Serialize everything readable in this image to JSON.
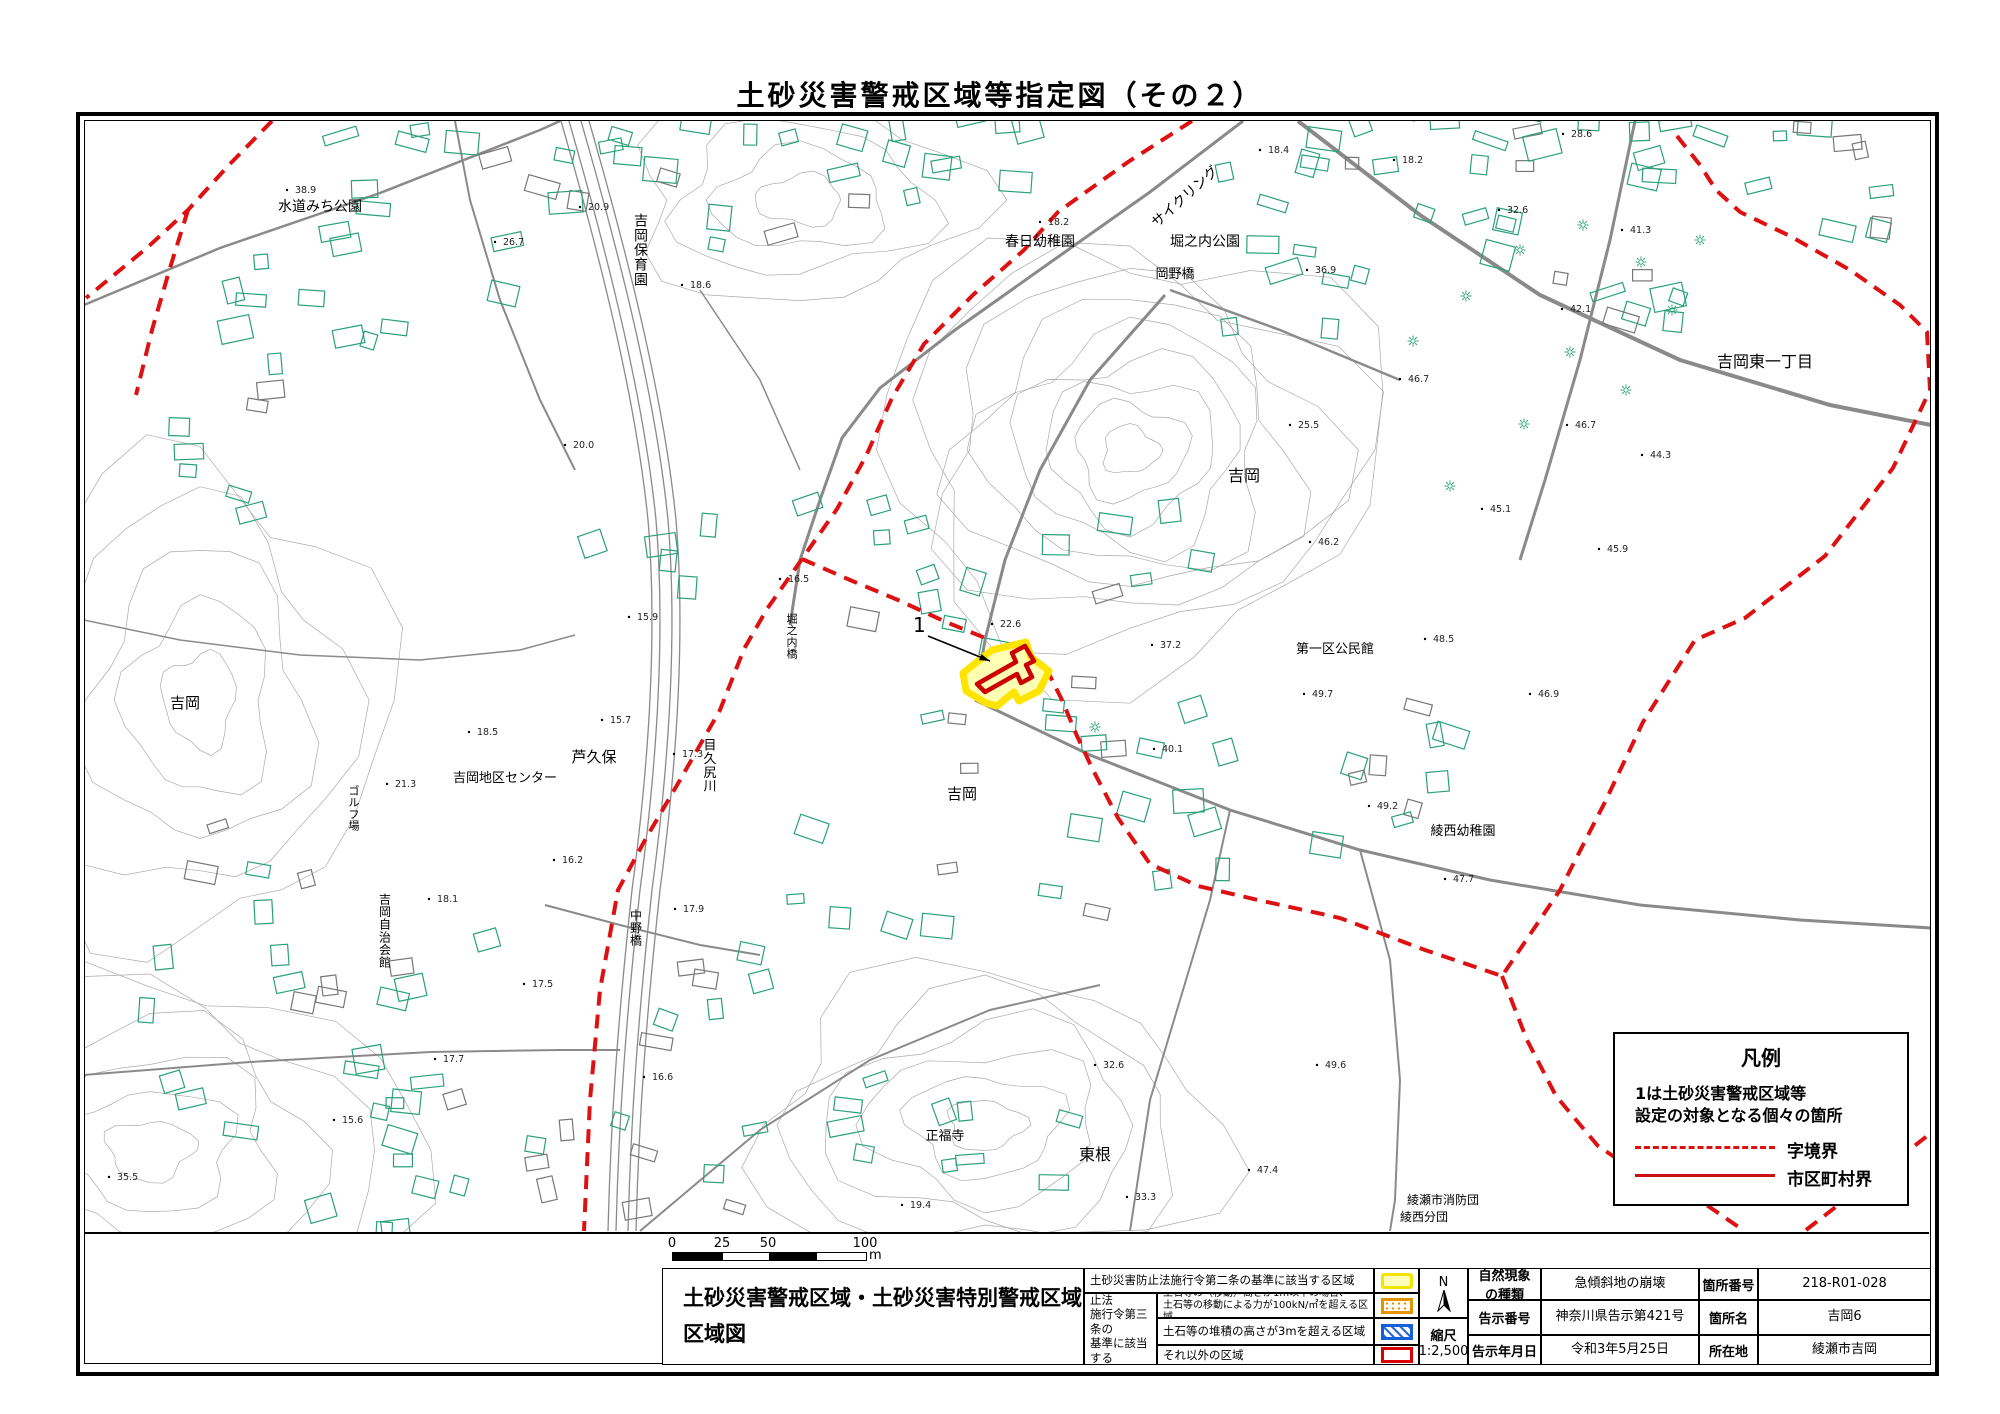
{
  "title": "土砂災害警戒区域等指定図（その２）",
  "legend": {
    "title": "凡例",
    "line1": "1は土砂災害警戒区域等",
    "line2": "設定の対象となる個々の箇所",
    "dashed_label": "字境界",
    "solid_label": "市区町村界",
    "dashed_color": "#dd1111",
    "solid_color": "#cc1111"
  },
  "scale_bar": {
    "ticks": [
      "0",
      "25",
      "50",
      "100"
    ],
    "unit": "m"
  },
  "table": {
    "map_title_line1": "土砂災害警戒区域・土砂災害特別警戒区域",
    "map_title_line2": "区域図",
    "row1_desc": "土砂災害防止法施行令第二条の基準に該当する区域",
    "law_line1": "土砂災害防止法",
    "law_line2": "施行令第三条の",
    "law_line3": "基準に該当する",
    "law_line4": "区域",
    "row2_desc_line1": "土石等の（移動）高さが1m以下の場合、",
    "row2_desc_line2": "土石等の移動による力が100kN/㎡を超える区域",
    "row3_desc": "土石等の堆積の高さが3mを超える区域",
    "row4_desc": "それ以外の区域",
    "north_label": "N",
    "scale_label": "縮尺",
    "scale_value": "1:2,500",
    "nature_label_l1": "自然現象",
    "nature_label_l2": "の種類",
    "nature_value": "急傾斜地の崩壊",
    "notice_no_label": "告示番号",
    "notice_no_value": "神奈川県告示第421号",
    "notice_date_label": "告示年月日",
    "notice_date_value": "令和3年5月25日",
    "site_no_label": "箇所番号",
    "site_no_value": "218-R01-028",
    "site_name_label": "箇所名",
    "site_name_value": "吉岡6",
    "location_label": "所在地",
    "location_value": "綾瀬市吉岡"
  },
  "map": {
    "marker": {
      "label": "1",
      "x": 913,
      "y": 632,
      "arrow": [
        928,
        636,
        990,
        661
      ]
    },
    "zone_fill": "#ffffb3",
    "zone_stroke": "#ffe400",
    "special_stroke": "#cc0000",
    "boundary_color": "#dd1111",
    "zone_points": "963,673 992,650 1026,642 1031,657 1049,671 1039,691 1019,701 1014,692 997,706 986,703 966,691",
    "special_path": "M 977,684 L 1016,662 L 1012,653 L 1025,646 L 1034,661 L 1026,665 L 1032,677 L 1021,683 L 1017,674 L 985,692 Z",
    "dashes": [
      "M 272,121 L 228,166 L 188,210 L 148,247 L 86,298",
      "M 188,210 L 170,268 L 152,330 L 136,395",
      "M 1192,121 L 1128,162 L 1058,212 L 1024,250 L 974,294 L 924,344 L 892,398 L 866,456 L 837,509 L 802,559 L 767,609 L 744,649 L 720,710 L 680,780 L 645,840 L 618,890 L 600,990 L 590,1100 L 584,1231",
      "M 802,559 L 850,580 L 898,600 L 946,622 L 990,640",
      "M 1046,668 L 1062,700 L 1077,736 L 1093,770 L 1118,818 L 1150,864 L 1198,886 L 1258,900 L 1340,918 L 1425,950 L 1502,976",
      "M 1677,136 L 1700,165 L 1716,190 L 1740,212 L 1790,236 L 1850,270 L 1900,305 L 1927,332 L 1930,390 L 1893,468 L 1825,556 L 1745,618 L 1695,640 L 1643,722 L 1605,802 L 1560,890 L 1502,976",
      "M 1502,976 L 1527,1040 L 1556,1096 L 1598,1146 L 1658,1186 L 1708,1206 L 1743,1230",
      "M 1806,1230 L 1868,1182 L 1931,1133"
    ],
    "river": {
      "d": "M 575,121 C 615,260 650,400 662,520 C 672,640 662,770 646,890 C 633,1010 625,1110 622,1231",
      "offsets": [
        -14,
        -6,
        6,
        14
      ]
    },
    "roads": [
      {
        "d": "M 1243,121 L 1150,192 L 1048,264 L 955,330 L 880,388 L 842,438 L 820,500 L 800,560 L 790,625",
        "w": 3
      },
      {
        "d": "M 84,305 L 220,248 L 380,193 L 540,130 L 560,121",
        "w": 2.5
      },
      {
        "d": "M 455,121 L 470,200 L 500,300 L 540,400 L 575,470",
        "w": 2
      },
      {
        "d": "M 1298,121 L 1420,215 L 1540,295 L 1680,360 L 1830,405 L 1931,425",
        "w": 4
      },
      {
        "d": "M 1635,121 L 1610,240 L 1580,360 L 1545,480 L 1520,560",
        "w": 3
      },
      {
        "d": "M 1165,295 L 1090,380 L 1040,470 L 1005,560 L 985,640 L 975,700",
        "w": 3
      },
      {
        "d": "M 975,700 L 1090,755 L 1230,810 L 1360,850 L 1490,880 L 1640,905 L 1800,920 L 1931,928",
        "w": 3
      },
      {
        "d": "M 1360,850 L 1390,960 L 1400,1080 L 1395,1200 L 1390,1231",
        "w": 2
      },
      {
        "d": "M 84,1075 L 250,1062 L 430,1052 L 560,1050 L 620,1050",
        "w": 2
      },
      {
        "d": "M 640,1231 L 760,1130 L 870,1060 L 990,1010 L 1100,985",
        "w": 2
      },
      {
        "d": "M 545,905 L 620,925 L 700,945 L 760,955",
        "w": 2
      },
      {
        "d": "M 84,620 L 180,640 L 300,655 L 420,660 L 520,650 L 575,635",
        "w": 1.5
      },
      {
        "d": "M 1230,810 L 1210,900 L 1180,1000 L 1150,1100 L 1130,1231",
        "w": 2
      },
      {
        "d": "M 700,290 L 760,380 L 800,470",
        "w": 1.5
      },
      {
        "d": "M 1170,290 L 1280,330 L 1400,380",
        "w": 2.5
      }
    ],
    "contour_zones": [
      {
        "cx": 1130,
        "cy": 450,
        "rx": 250,
        "ry": 215,
        "n": 9
      },
      {
        "cx": 985,
        "cy": 1125,
        "rx": 230,
        "ry": 150,
        "n": 6
      },
      {
        "cx": 150,
        "cy": 1150,
        "rx": 260,
        "ry": 180,
        "n": 6
      },
      {
        "cx": 200,
        "cy": 700,
        "rx": 180,
        "ry": 240,
        "n": 5
      },
      {
        "cx": 800,
        "cy": 200,
        "rx": 170,
        "ry": 100,
        "n": 4
      }
    ],
    "building_clusters": [
      [
        380,
        230,
        170,
        100,
        16
      ],
      [
        565,
        165,
        70,
        45,
        6
      ],
      [
        830,
        205,
        130,
        75,
        10
      ],
      [
        1440,
        210,
        240,
        120,
        30
      ],
      [
        1760,
        210,
        150,
        95,
        16
      ],
      [
        1350,
        130,
        100,
        40,
        8
      ],
      [
        300,
        430,
        130,
        95,
        10
      ],
      [
        905,
        555,
        110,
        75,
        9
      ],
      [
        1060,
        725,
        130,
        85,
        10
      ],
      [
        1305,
        785,
        160,
        85,
        12
      ],
      [
        1160,
        855,
        110,
        65,
        8
      ],
      [
        255,
        905,
        140,
        115,
        10
      ],
      [
        425,
        1005,
        130,
        95,
        9
      ],
      [
        310,
        1155,
        160,
        75,
        10
      ],
      [
        760,
        1125,
        140,
        85,
        10
      ],
      [
        960,
        1150,
        110,
        65,
        7
      ],
      [
        705,
        985,
        90,
        55,
        6
      ],
      [
        490,
        1155,
        110,
        65,
        8
      ],
      [
        1490,
        120,
        80,
        40,
        6
      ],
      [
        700,
        140,
        80,
        40,
        6
      ],
      [
        980,
        140,
        90,
        45,
        7
      ],
      [
        1130,
        560,
        80,
        50,
        6
      ],
      [
        870,
        880,
        90,
        55,
        6
      ],
      [
        640,
        560,
        70,
        45,
        5
      ]
    ],
    "suns": [
      [
        1413,
        341
      ],
      [
        1466,
        296
      ],
      [
        1520,
        250
      ],
      [
        1583,
        225
      ],
      [
        1641,
        262
      ],
      [
        1700,
        240
      ],
      [
        1570,
        352
      ],
      [
        1626,
        390
      ],
      [
        1524,
        424
      ],
      [
        1450,
        486
      ],
      [
        1672,
        310
      ],
      [
        1095,
        727
      ]
    ],
    "labels": [
      {
        "t": "水道みち公園",
        "x": 320,
        "y": 211,
        "fs": 14
      },
      {
        "t": "吉岡保育園",
        "x": 641,
        "y": 255,
        "fs": 14,
        "vert": true
      },
      {
        "t": "春日幼稚園",
        "x": 1040,
        "y": 246,
        "fs": 14
      },
      {
        "t": "サイクリング",
        "x": 1188,
        "y": 200,
        "fs": 14,
        "rot": -42
      },
      {
        "t": "堀之内公園",
        "x": 1205,
        "y": 246,
        "fs": 14
      },
      {
        "t": "岡野橋",
        "x": 1175,
        "y": 278,
        "fs": 13
      },
      {
        "t": "吉岡東一丁目",
        "x": 1765,
        "y": 367,
        "fs": 16
      },
      {
        "t": "吉岡",
        "x": 1244,
        "y": 481,
        "fs": 16
      },
      {
        "t": "吉岡",
        "x": 185,
        "y": 708,
        "fs": 15
      },
      {
        "t": "吉岡",
        "x": 962,
        "y": 799,
        "fs": 15
      },
      {
        "t": "第一区公民館",
        "x": 1335,
        "y": 653,
        "fs": 13
      },
      {
        "t": "綾西幼稚園",
        "x": 1463,
        "y": 835,
        "fs": 13
      },
      {
        "t": "芦久保",
        "x": 594,
        "y": 762,
        "fs": 15
      },
      {
        "t": "吉岡地区センター",
        "x": 505,
        "y": 782,
        "fs": 13
      },
      {
        "t": "目久尻川",
        "x": 710,
        "y": 770,
        "fs": 13,
        "vert": true
      },
      {
        "t": "ゴルフ場",
        "x": 354,
        "y": 812,
        "fs": 11,
        "vert": true
      },
      {
        "t": "堀之内橋",
        "x": 792,
        "y": 640,
        "fs": 11,
        "vert": true
      },
      {
        "t": "吉岡自治会館",
        "x": 385,
        "y": 935,
        "fs": 12,
        "vert": true
      },
      {
        "t": "中野橋",
        "x": 636,
        "y": 932,
        "fs": 12,
        "vert": true
      },
      {
        "t": "正福寺",
        "x": 945,
        "y": 1140,
        "fs": 13
      },
      {
        "t": "東根",
        "x": 1095,
        "y": 1160,
        "fs": 16
      },
      {
        "t": "綾瀬市消防団",
        "x": 1443,
        "y": 1204,
        "fs": 12
      },
      {
        "t": "綾西分団",
        "x": 1424,
        "y": 1221,
        "fs": 12
      }
    ],
    "spots": [
      [
        295,
        193,
        "38.9"
      ],
      [
        588,
        210,
        "20.9"
      ],
      [
        503,
        245,
        "26.7"
      ],
      [
        690,
        288,
        "18.6"
      ],
      [
        1048,
        225,
        "18.2"
      ],
      [
        1268,
        153,
        "18.4"
      ],
      [
        1402,
        163,
        "18.2"
      ],
      [
        1315,
        273,
        "36.9"
      ],
      [
        1571,
        137,
        "28.6"
      ],
      [
        1507,
        213,
        "32.6"
      ],
      [
        1630,
        233,
        "41.3"
      ],
      [
        1570,
        312,
        "42.1"
      ],
      [
        1298,
        428,
        "25.5"
      ],
      [
        1408,
        382,
        "46.7"
      ],
      [
        1575,
        428,
        "46.7"
      ],
      [
        1650,
        458,
        "44.3"
      ],
      [
        1318,
        545,
        "46.2"
      ],
      [
        1607,
        552,
        "45.9"
      ],
      [
        1490,
        512,
        "45.1"
      ],
      [
        1000,
        627,
        "22.6"
      ],
      [
        1160,
        648,
        "37.2"
      ],
      [
        1162,
        752,
        "40.1"
      ],
      [
        1433,
        642,
        "48.5"
      ],
      [
        1312,
        697,
        "49.7"
      ],
      [
        1538,
        697,
        "46.9"
      ],
      [
        477,
        735,
        "18.5"
      ],
      [
        610,
        723,
        "15.7"
      ],
      [
        682,
        757,
        "17.3"
      ],
      [
        395,
        787,
        "21.3"
      ],
      [
        562,
        863,
        "16.2"
      ],
      [
        573,
        448,
        "20.0"
      ],
      [
        637,
        620,
        "15.9"
      ],
      [
        788,
        582,
        "16.5"
      ],
      [
        437,
        902,
        "18.1"
      ],
      [
        683,
        912,
        "17.9"
      ],
      [
        532,
        987,
        "17.5"
      ],
      [
        443,
        1062,
        "17.7"
      ],
      [
        652,
        1080,
        "16.6"
      ],
      [
        342,
        1123,
        "15.6"
      ],
      [
        1103,
        1068,
        "32.6"
      ],
      [
        1325,
        1068,
        "49.6"
      ],
      [
        1257,
        1173,
        "47.4"
      ],
      [
        1135,
        1200,
        "33.3"
      ],
      [
        910,
        1208,
        "19.4"
      ],
      [
        1377,
        809,
        "49.2"
      ],
      [
        1453,
        882,
        "47.7"
      ],
      [
        117,
        1180,
        "35.5"
      ]
    ]
  }
}
